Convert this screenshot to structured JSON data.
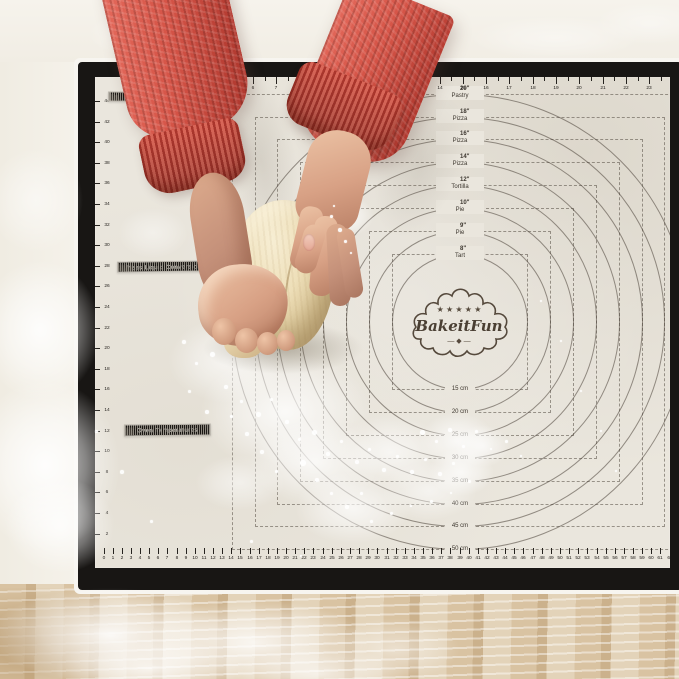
{
  "brand": {
    "stars": "★ ★ ★ ★ ★",
    "name": "BakeitFun",
    "flourish": "— ◆ —"
  },
  "rulers": {
    "top_unit": "in",
    "top_numbers": [
      1,
      2,
      3,
      4,
      5,
      6,
      7,
      8,
      9,
      10,
      11,
      12,
      13,
      14,
      15,
      16,
      17,
      18,
      19,
      20,
      21,
      22,
      23,
      24
    ],
    "bottom_unit": "cm",
    "bottom_numbers": [
      0,
      1,
      2,
      3,
      4,
      5,
      6,
      7,
      8,
      9,
      10,
      11,
      12,
      13,
      14,
      15,
      16,
      17,
      18,
      19,
      20,
      21,
      22,
      23,
      24,
      25,
      26,
      27,
      28,
      29,
      30,
      31,
      32,
      33,
      34,
      35,
      36,
      37,
      38,
      39,
      40,
      41,
      42,
      43,
      44,
      45,
      46,
      47,
      48,
      49,
      50,
      51,
      52,
      53,
      54,
      55,
      56,
      57,
      58,
      59,
      60,
      61,
      62,
      63
    ],
    "left_numbers": [
      44,
      42,
      40,
      38,
      36,
      34,
      32,
      30,
      28,
      26,
      24,
      22,
      20,
      18,
      16,
      14,
      12,
      10,
      8,
      6,
      4,
      2
    ]
  },
  "rings": [
    {
      "size_in": "8\"",
      "use": "Tart",
      "size_cm": "15 cm",
      "diameter_cm": 15
    },
    {
      "size_in": "9\"",
      "use": "Pie",
      "size_cm": "20 cm",
      "diameter_cm": 20
    },
    {
      "size_in": "10\"",
      "use": "Pie",
      "size_cm": "25 cm",
      "diameter_cm": 25
    },
    {
      "size_in": "12\"",
      "use": "Tortilla",
      "size_cm": "30 cm",
      "diameter_cm": 30
    },
    {
      "size_in": "14\"",
      "use": "Pizza",
      "size_cm": "35 cm",
      "diameter_cm": 35
    },
    {
      "size_in": "16\"",
      "use": "Pizza",
      "size_cm": "40 cm",
      "diameter_cm": 40
    },
    {
      "size_in": "18\"",
      "use": "Pizza",
      "size_cm": "45 cm",
      "diameter_cm": 45
    },
    {
      "size_in": "20\"",
      "use": "Pastry",
      "size_cm": "50 cm",
      "diameter_cm": 50
    }
  ],
  "charts": {
    "weight": {
      "title": "Weight",
      "rows": [
        [
          "70g",
          "2 ½"
        ],
        [
          "75g",
          "2 ¾"
        ],
        [
          "85g",
          "3"
        ],
        [
          "100g",
          "3 ½"
        ],
        [
          "110g",
          "4"
        ],
        [
          "125g",
          "4 ½"
        ],
        [
          "150g",
          "5 ¼"
        ],
        [
          "175g",
          "6 ¼"
        ]
      ]
    },
    "liquid": {
      "title": "Mass Liquid Conversions",
      "rows": [
        [
          "",
          "",
          "",
          "½ fl oz"
        ],
        [
          "",
          "",
          "⅛ cup",
          "1 fl oz"
        ],
        [
          "",
          "",
          "¼ cup",
          "2 fl oz"
        ],
        [
          "",
          "",
          "½ cup",
          "4 fl oz"
        ],
        [
          "¼ pt",
          "½ c",
          "1 cup",
          "8 fl oz"
        ],
        [
          "½ pt",
          "1 c",
          "2 cups",
          "16 fl oz"
        ],
        [
          "1 pt",
          "2 c",
          "4 cups",
          "32 fl oz"
        ],
        [
          "½ gal",
          "2 qt",
          "8 cups",
          "64 fl oz"
        ],
        [
          "1 gal",
          "4 qt",
          "16 cups",
          "128 fl oz"
        ]
      ]
    },
    "oven": {
      "title": "Oven Temperatures",
      "headers": [
        "Gas",
        "°C",
        "°F"
      ],
      "rows": [
        [
          "1",
          "140",
          "275"
        ],
        [
          "2",
          "150",
          "300"
        ],
        [
          "3",
          "160",
          "325"
        ],
        [
          "4",
          "180",
          "350"
        ],
        [
          "5",
          "190",
          "375"
        ],
        [
          "6",
          "200",
          "400"
        ],
        [
          "7",
          "220",
          "425"
        ],
        [
          "8",
          "230",
          "450"
        ],
        [
          "9",
          "250",
          "475"
        ]
      ]
    }
  }
}
